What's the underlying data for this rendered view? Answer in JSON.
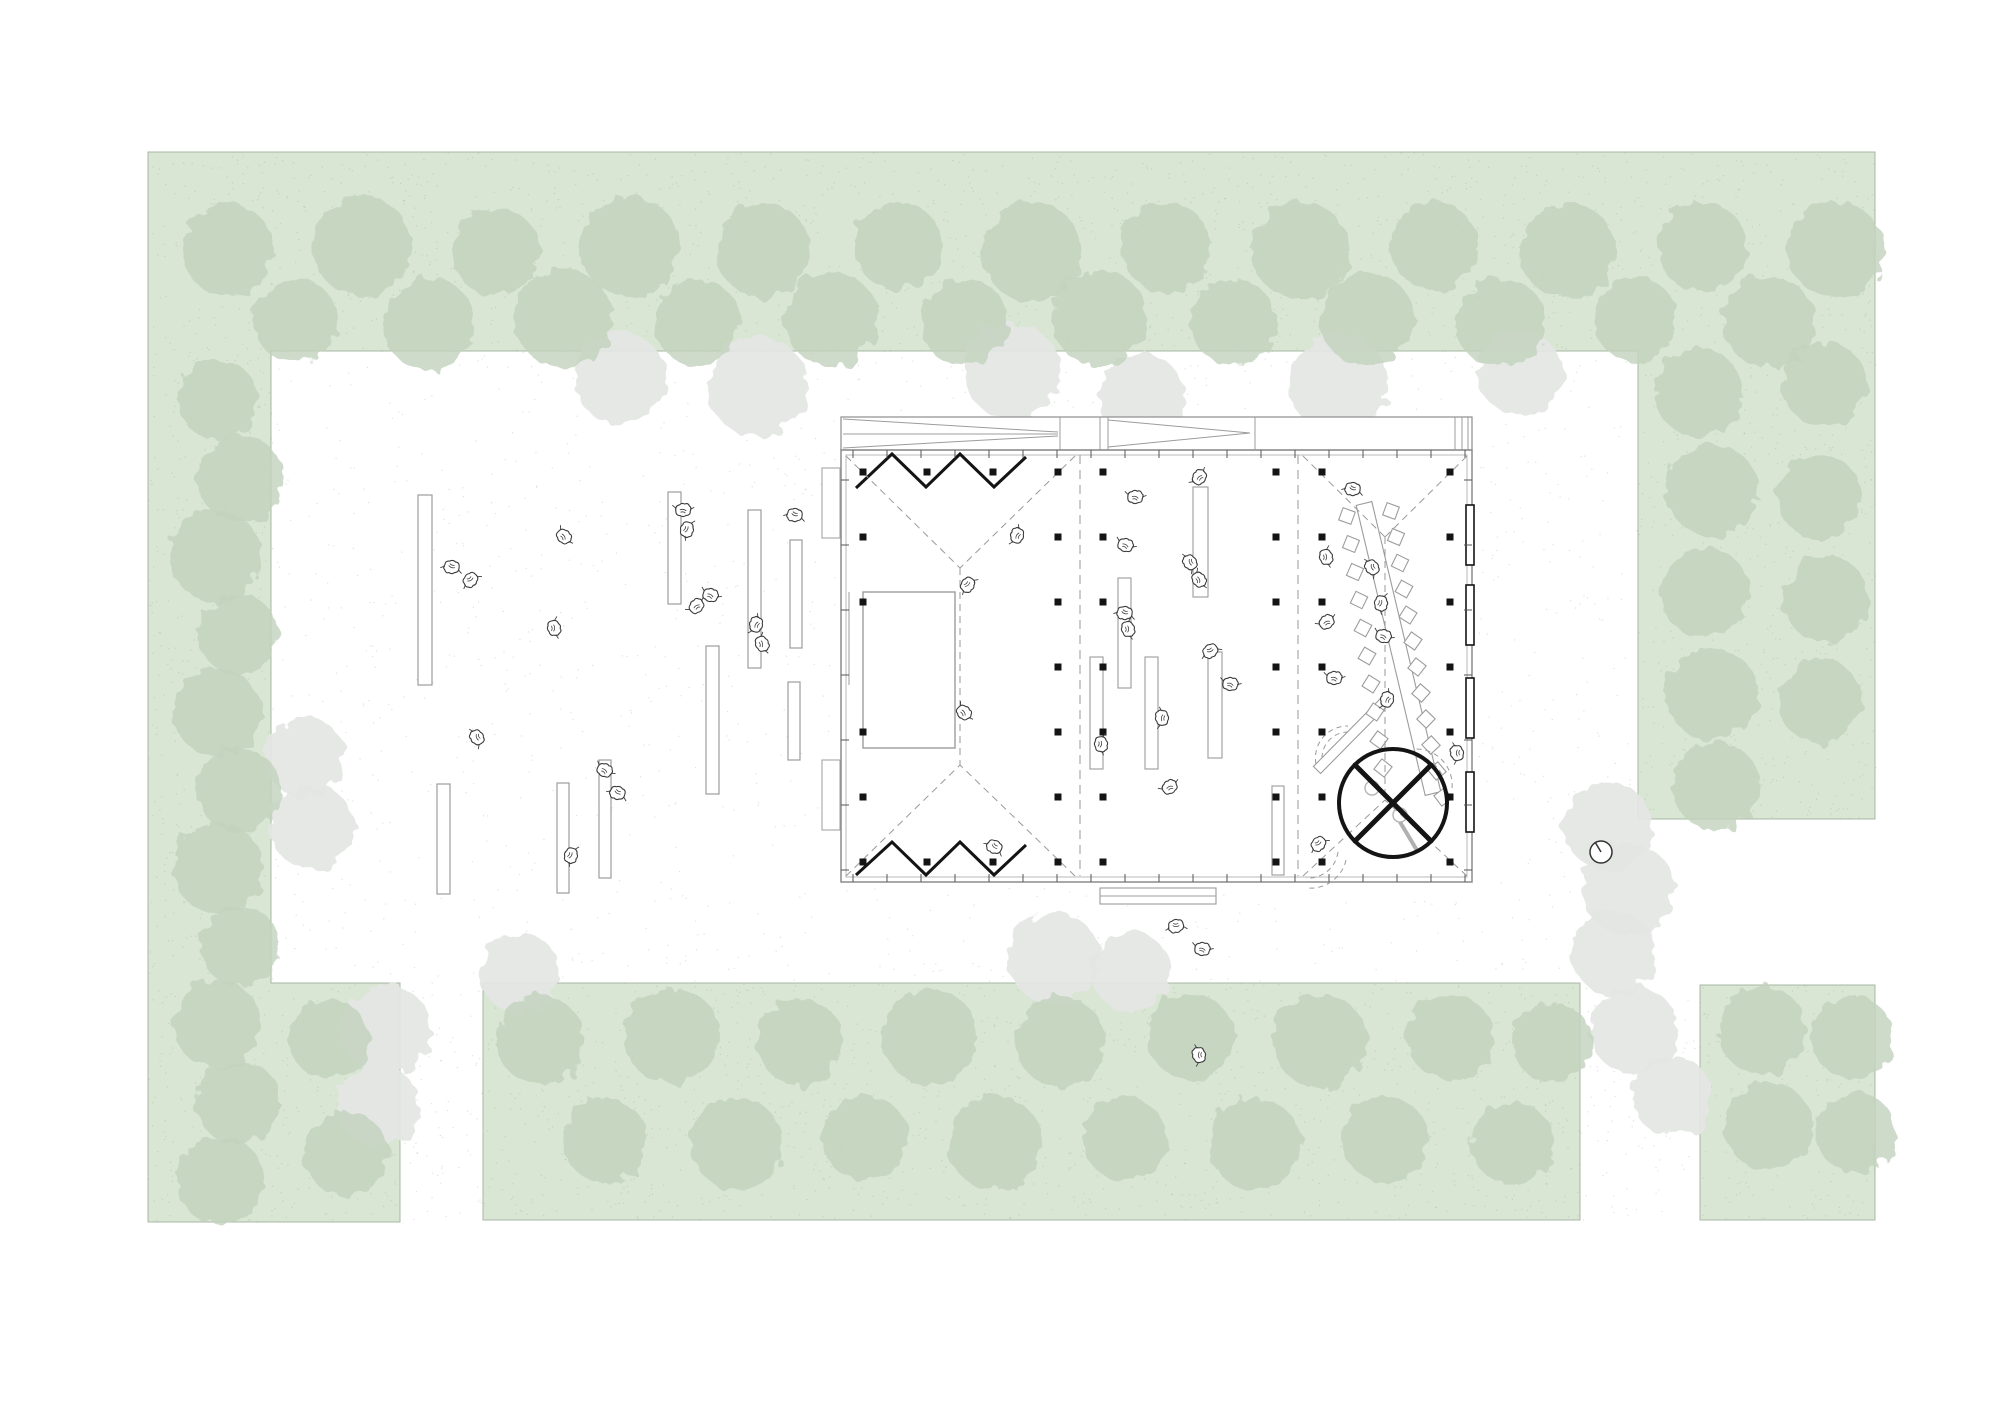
{
  "scene": {
    "canvas": {
      "width": 2000,
      "height": 1415,
      "background": "#ffffff"
    },
    "colors": {
      "green": "#d8e6d3",
      "green_edge": "#a9b7a4",
      "tree_green": "#c2d2bd",
      "tree_gray": "#e4e6e4",
      "green_dot": "#72906d",
      "plaza_dot": "#97a097",
      "wall": "#8c8c8c",
      "light_line": "#9c9c9c",
      "inner_line": "#b8b8b8",
      "dashed": "#9a9a9a",
      "black": "#141414",
      "figure": "#3c3c3c"
    },
    "green_areas": [
      {
        "name": "green-band-perimeter",
        "points": "148,152 1875,152 1875,819 1638,819 1638,351 271,351 271,983 400,983 400,1222 148,1222"
      },
      {
        "name": "green-band-south",
        "points": "483,983 1580,983 1580,1220 483,1220"
      },
      {
        "name": "green-block-southeast",
        "points": "1700,985 1875,985 1875,1220 1700,1220"
      }
    ],
    "stipple_regions": [
      {
        "rect": [
          148,
          152,
          1727,
          199
        ],
        "count": 1500,
        "color": "#72906d",
        "opacity": 0.22
      },
      {
        "rect": [
          148,
          351,
          123,
          871
        ],
        "count": 520,
        "color": "#72906d",
        "opacity": 0.22
      },
      {
        "rect": [
          271,
          983,
          129,
          239
        ],
        "count": 160,
        "color": "#72906d",
        "opacity": 0.22
      },
      {
        "rect": [
          483,
          983,
          1097,
          237
        ],
        "count": 1150,
        "color": "#72906d",
        "opacity": 0.22
      },
      {
        "rect": [
          1638,
          351,
          237,
          468
        ],
        "count": 520,
        "color": "#72906d",
        "opacity": 0.22
      },
      {
        "rect": [
          1700,
          985,
          175,
          235
        ],
        "count": 200,
        "color": "#72906d",
        "opacity": 0.22
      },
      {
        "rect": [
          271,
          351,
          1367,
          632
        ],
        "count": 1500,
        "color": "#97a097",
        "opacity": 0.3,
        "avoid_building": true
      },
      {
        "rect": [
          400,
          983,
          83,
          239
        ],
        "count": 70,
        "color": "#97a097",
        "opacity": 0.3
      },
      {
        "rect": [
          1580,
          983,
          120,
          237
        ],
        "count": 90,
        "color": "#97a097",
        "opacity": 0.3
      }
    ],
    "trees_green": [
      [
        228,
        250,
        46
      ],
      [
        362,
        246,
        50
      ],
      [
        496,
        252,
        44
      ],
      [
        630,
        247,
        50
      ],
      [
        764,
        251,
        47
      ],
      [
        898,
        246,
        44
      ],
      [
        1032,
        252,
        50
      ],
      [
        1166,
        247,
        45
      ],
      [
        1300,
        250,
        49
      ],
      [
        1434,
        246,
        44
      ],
      [
        1568,
        251,
        48
      ],
      [
        1702,
        247,
        45
      ],
      [
        1836,
        250,
        48
      ],
      [
        295,
        320,
        42
      ],
      [
        429,
        324,
        46
      ],
      [
        563,
        318,
        49
      ],
      [
        697,
        322,
        43
      ],
      [
        831,
        319,
        47
      ],
      [
        965,
        323,
        44
      ],
      [
        1099,
        318,
        48
      ],
      [
        1233,
        322,
        43
      ],
      [
        1367,
        319,
        47
      ],
      [
        1501,
        323,
        45
      ],
      [
        1635,
        319,
        42
      ],
      [
        1769,
        322,
        46
      ],
      [
        218,
        400,
        40
      ],
      [
        240,
        478,
        43
      ],
      [
        216,
        556,
        46
      ],
      [
        238,
        634,
        40
      ],
      [
        217,
        712,
        44
      ],
      [
        239,
        790,
        42
      ],
      [
        218,
        868,
        45
      ],
      [
        240,
        946,
        40
      ],
      [
        217,
        1024,
        44
      ],
      [
        238,
        1102,
        42
      ],
      [
        220,
        1180,
        44
      ],
      [
        1698,
        392,
        44
      ],
      [
        1824,
        384,
        42
      ],
      [
        1712,
        490,
        46
      ],
      [
        1820,
        497,
        42
      ],
      [
        1704,
        592,
        45
      ],
      [
        1826,
        599,
        43
      ],
      [
        1712,
        694,
        46
      ],
      [
        1820,
        701,
        42
      ],
      [
        1716,
        786,
        44
      ],
      [
        540,
        1040,
        44
      ],
      [
        672,
        1036,
        48
      ],
      [
        800,
        1042,
        43
      ],
      [
        930,
        1037,
        48
      ],
      [
        1060,
        1041,
        45
      ],
      [
        1190,
        1036,
        43
      ],
      [
        1320,
        1041,
        47
      ],
      [
        1450,
        1037,
        43
      ],
      [
        1552,
        1042,
        40
      ],
      [
        605,
        1140,
        42
      ],
      [
        737,
        1144,
        46
      ],
      [
        865,
        1138,
        43
      ],
      [
        995,
        1143,
        47
      ],
      [
        1125,
        1139,
        42
      ],
      [
        1255,
        1144,
        46
      ],
      [
        1385,
        1139,
        43
      ],
      [
        1512,
        1143,
        41
      ],
      [
        330,
        1040,
        40
      ],
      [
        346,
        1154,
        42
      ],
      [
        1762,
        1030,
        44
      ],
      [
        1852,
        1037,
        41
      ],
      [
        1768,
        1126,
        44
      ],
      [
        1856,
        1133,
        40
      ]
    ],
    "trees_gray": [
      [
        620,
        378,
        46
      ],
      [
        757,
        386,
        50
      ],
      [
        1012,
        371,
        48
      ],
      [
        1142,
        397,
        43
      ],
      [
        1338,
        383,
        50
      ],
      [
        1520,
        373,
        42
      ],
      [
        305,
        757,
        40
      ],
      [
        312,
        827,
        42
      ],
      [
        386,
        1030,
        45
      ],
      [
        378,
        1106,
        41
      ],
      [
        520,
        973,
        40
      ],
      [
        1054,
        958,
        46
      ],
      [
        1131,
        972,
        40
      ],
      [
        1608,
        826,
        44
      ],
      [
        1628,
        889,
        46
      ],
      [
        1614,
        953,
        42
      ],
      [
        1634,
        1030,
        44
      ],
      [
        1672,
        1096,
        40
      ]
    ],
    "building": {
      "avoid_bbox": [
        835,
        411,
        643,
        477
      ],
      "body": [
        841,
        417,
        631,
        465
      ],
      "roof_strip": {
        "rect": [
          841,
          417,
          631,
          33
        ],
        "verticals": [
          1060,
          1100,
          1108,
          1255,
          1455,
          1462,
          1468
        ],
        "lines": [
          [
            843,
            419,
            1058,
            432
          ],
          [
            843,
            448,
            1058,
            436
          ],
          [
            843,
            434,
            1058,
            434
          ],
          [
            1108,
            420,
            1250,
            433
          ],
          [
            1108,
            447,
            1250,
            433
          ]
        ]
      },
      "hall_rect": [
        841,
        450,
        631,
        432
      ],
      "inner_rect": [
        846,
        455,
        621,
        422
      ],
      "ticks": {
        "top": [
          853,
          1465,
          34,
          450,
          458
        ],
        "bottom": [
          853,
          1465,
          34,
          874,
          882
        ],
        "left": [
          480,
          870,
          65,
          841,
          849
        ],
        "right": [
          480,
          870,
          65,
          1464,
          1472
        ]
      },
      "door_panels_right": [
        [
          1466,
          505
        ],
        [
          1466,
          585
        ],
        [
          1466,
          678
        ],
        [
          1466,
          772
        ]
      ],
      "door_panel_size": [
        8,
        60
      ],
      "wall_panels_left": [
        [
          822,
          468
        ],
        [
          822,
          760
        ]
      ],
      "wall_panel_size": [
        18,
        70
      ],
      "bay_dividers_x": [
        1080,
        1298
      ],
      "bay_divider_y": [
        455,
        876
      ],
      "dashed_lines": [
        [
          846,
          456,
          960,
          568
        ],
        [
          1075,
          456,
          960,
          568
        ],
        [
          960,
          568,
          960,
          765
        ],
        [
          846,
          876,
          960,
          765
        ],
        [
          1075,
          876,
          960,
          765
        ],
        [
          1303,
          456,
          1385,
          537
        ],
        [
          1467,
          456,
          1385,
          537
        ],
        [
          1385,
          537,
          1385,
          800
        ],
        [
          1303,
          876,
          1385,
          800
        ],
        [
          1467,
          876,
          1385,
          800
        ]
      ],
      "zigzag_top": "856,488 892,454 926,487 960,454 994,487 1026,457",
      "zigzag_bottom": "856,875 892,842 926,875 960,842 994,875 1026,845",
      "stage": {
        "rect": [
          863,
          592,
          92,
          156
        ],
        "line": [
          849,
          592,
          849,
          685
        ]
      },
      "benches_hall": [
        [
          1193,
          487,
          15,
          110
        ],
        [
          1118,
          578,
          13,
          110
        ],
        [
          1090,
          657,
          13,
          112
        ],
        [
          1145,
          657,
          13,
          112
        ],
        [
          1208,
          652,
          14,
          106
        ],
        [
          1272,
          786,
          12,
          89
        ]
      ],
      "bench_horizontal": [
        1100,
        888,
        116,
        16
      ],
      "long_table_points": "1356.2,505.4 1371.8,501.6 1440.8,791.6 1425.2,795.4",
      "diag_bench_points": "1313.4,766.5 1320.6,773.5 1393.6,699.5 1386.4,692.5",
      "chairs": [
        [
          1347,
          516,
          20
        ],
        [
          1351,
          544,
          22
        ],
        [
          1355,
          572,
          24
        ],
        [
          1359,
          600,
          26
        ],
        [
          1363,
          628,
          28
        ],
        [
          1367,
          656,
          30
        ],
        [
          1371,
          684,
          32
        ],
        [
          1375,
          712,
          34
        ],
        [
          1379,
          740,
          36
        ],
        [
          1383,
          768,
          38
        ],
        [
          1391,
          511,
          20
        ],
        [
          1396,
          537,
          23
        ],
        [
          1400,
          563,
          26
        ],
        [
          1404,
          589,
          29
        ],
        [
          1408,
          615,
          32
        ],
        [
          1413,
          641,
          35
        ],
        [
          1417,
          667,
          38
        ],
        [
          1421,
          693,
          41
        ],
        [
          1426,
          719,
          44
        ],
        [
          1431,
          745,
          47
        ],
        [
          1437,
          771,
          50
        ],
        [
          1443,
          797,
          53
        ]
      ],
      "chair_size": 13,
      "columns": [
        [
          863,
          472
        ],
        [
          863,
          537
        ],
        [
          863,
          602
        ],
        [
          863,
          732
        ],
        [
          863,
          797
        ],
        [
          863,
          862
        ],
        [
          1058,
          472
        ],
        [
          1058,
          537
        ],
        [
          1058,
          602
        ],
        [
          1058,
          667
        ],
        [
          1058,
          732
        ],
        [
          1058,
          797
        ],
        [
          1058,
          862
        ],
        [
          927,
          472
        ],
        [
          927,
          862
        ],
        [
          993,
          472
        ],
        [
          993,
          862
        ],
        [
          1103,
          472
        ],
        [
          1103,
          537
        ],
        [
          1103,
          602
        ],
        [
          1103,
          667
        ],
        [
          1103,
          732
        ],
        [
          1103,
          797
        ],
        [
          1103,
          862
        ],
        [
          1276,
          472
        ],
        [
          1276,
          537
        ],
        [
          1276,
          602
        ],
        [
          1276,
          667
        ],
        [
          1276,
          732
        ],
        [
          1276,
          797
        ],
        [
          1276,
          862
        ],
        [
          1322,
          472
        ],
        [
          1322,
          537
        ],
        [
          1322,
          602
        ],
        [
          1322,
          667
        ],
        [
          1322,
          732
        ],
        [
          1322,
          797
        ],
        [
          1322,
          862
        ],
        [
          1450,
          472
        ],
        [
          1450,
          537
        ],
        [
          1450,
          602
        ],
        [
          1450,
          667
        ],
        [
          1450,
          732
        ],
        [
          1450,
          797
        ],
        [
          1450,
          862
        ]
      ],
      "column_size": 7,
      "kiosk": {
        "center": [
          1393,
          803
        ],
        "r": 54,
        "cross": [
          [
            1355,
            765,
            1431,
            841
          ],
          [
            1431,
            765,
            1355,
            841
          ]
        ],
        "stools": [
          [
            1372,
            788,
            7
          ],
          [
            1400,
            815,
            7
          ]
        ],
        "gray_bar": [
          1400,
          822,
          1418,
          852
        ],
        "dashed_arcs": [
          "M 1322,758 A 26 26 0 0 1 1348,732",
          "M 1316,764 A 32 32 0 0 1 1348,726",
          "M 1444,792 A 30 30 0 0 0 1414,757",
          "M 1452,788 A 36 36 0 0 0 1414,749",
          "M 1338,852 A 30 30 0 0 1 1306,878",
          "M 1346,860 A 36 36 0 0 1 1308,888"
        ]
      }
    },
    "benches_plaza": [
      [
        418,
        495,
        14,
        190
      ],
      [
        668,
        492,
        13,
        112
      ],
      [
        748,
        510,
        13,
        158
      ],
      [
        790,
        540,
        12,
        108
      ],
      [
        706,
        646,
        13,
        148
      ],
      [
        788,
        682,
        12,
        78
      ],
      [
        557,
        783,
        12,
        110
      ],
      [
        599,
        760,
        12,
        118
      ],
      [
        437,
        784,
        13,
        110
      ]
    ],
    "people": [
      [
        683,
        511,
        10
      ],
      [
        686,
        529,
        120
      ],
      [
        795,
        514,
        200
      ],
      [
        710,
        596,
        30
      ],
      [
        757,
        625,
        300
      ],
      [
        761,
        644,
        80
      ],
      [
        563,
        537,
        60
      ],
      [
        452,
        566,
        200
      ],
      [
        470,
        579,
        150
      ],
      [
        697,
        607,
        330
      ],
      [
        553,
        628,
        90
      ],
      [
        604,
        771,
        40
      ],
      [
        618,
        792,
        210
      ],
      [
        570,
        855,
        120
      ],
      [
        478,
        737,
        250
      ],
      [
        1018,
        536,
        300
      ],
      [
        967,
        584,
        140
      ],
      [
        963,
        713,
        60
      ],
      [
        995,
        846,
        220
      ],
      [
        1125,
        546,
        30
      ],
      [
        1125,
        612,
        200
      ],
      [
        1127,
        629,
        90
      ],
      [
        1200,
        478,
        320
      ],
      [
        1191,
        562,
        250
      ],
      [
        1198,
        580,
        70
      ],
      [
        1210,
        650,
        160
      ],
      [
        1230,
        685,
        20
      ],
      [
        1163,
        718,
        280
      ],
      [
        1100,
        744,
        100
      ],
      [
        1170,
        788,
        340
      ],
      [
        1176,
        925,
        180
      ],
      [
        1202,
        950,
        20
      ],
      [
        1200,
        1055,
        270
      ],
      [
        1135,
        498,
        15
      ],
      [
        1353,
        488,
        200
      ],
      [
        1325,
        557,
        90
      ],
      [
        1327,
        623,
        340
      ],
      [
        1373,
        567,
        250
      ],
      [
        1380,
        603,
        110
      ],
      [
        1383,
        637,
        30
      ],
      [
        1388,
        700,
        300
      ],
      [
        1334,
        679,
        15
      ],
      [
        1318,
        843,
        150
      ],
      [
        1458,
        753,
        270
      ]
    ],
    "clock": {
      "center": [
        1601,
        852
      ],
      "r": 11,
      "hand": [
        1601,
        852,
        1595,
        842
      ]
    }
  }
}
